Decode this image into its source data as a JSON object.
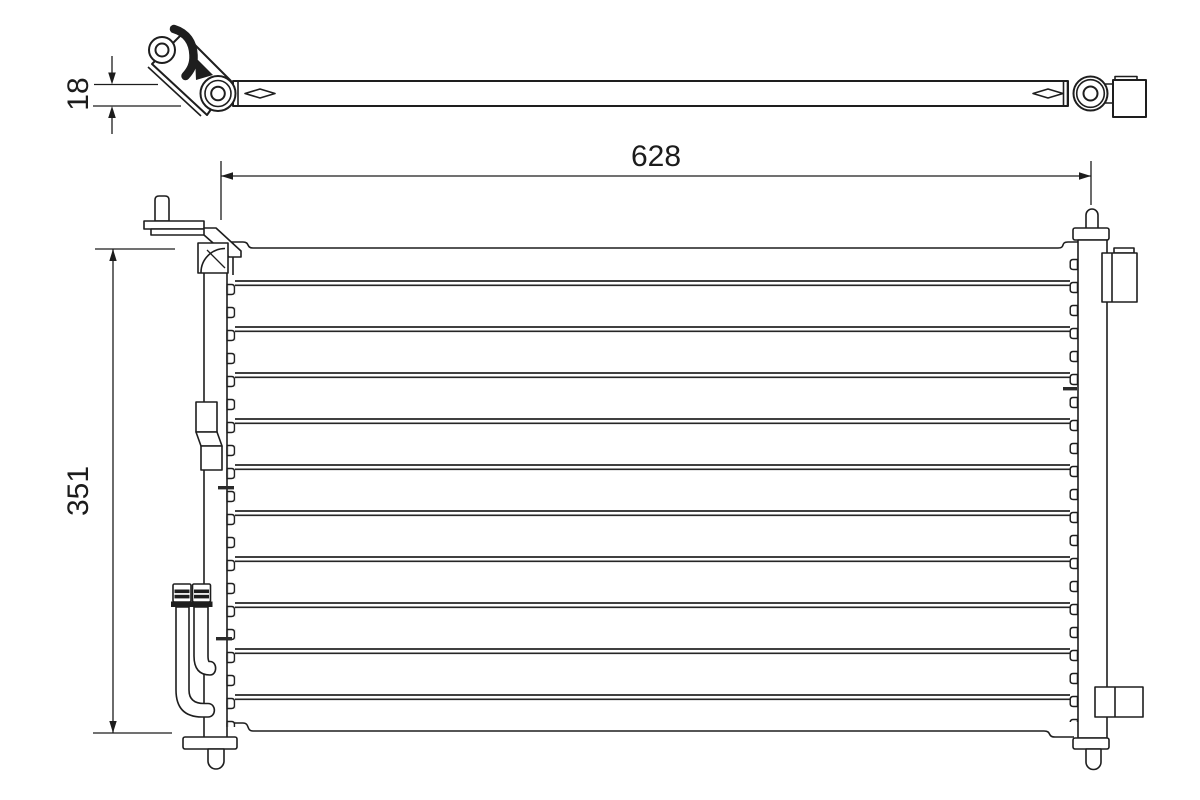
{
  "page": {
    "background": "#ffffff"
  },
  "drawing": {
    "line_color": "#1e1e1e",
    "text_color": "#1c1c1c",
    "views": {
      "top_view": "condenser-side-profile",
      "front_view": "condenser-front"
    },
    "front_view": {
      "tube_row_count": 10
    }
  },
  "dimensions": {
    "bar_thickness": "18",
    "overall_width": "628",
    "overall_height": "351"
  }
}
